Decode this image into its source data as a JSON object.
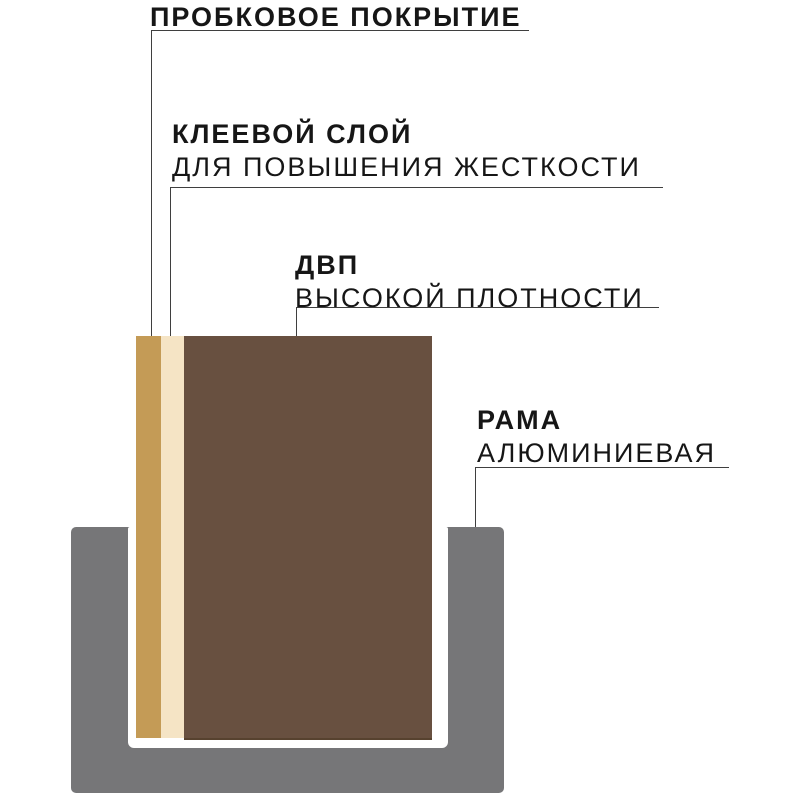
{
  "labels": {
    "cork": {
      "title": "ПРОБКОВОЕ ПОКРЫТИЕ"
    },
    "glue": {
      "title": "КЛЕЕВОЙ СЛОЙ",
      "subtitle": "ДЛЯ ПОВЫШЕНИЯ ЖЕСТКОСТИ"
    },
    "hdf": {
      "title": "ДВП",
      "subtitle": "ВЫСОКОЙ ПЛОТНОСТИ"
    },
    "frame": {
      "title": "РАМА",
      "subtitle": "АЛЮМИНИЕВАЯ"
    }
  },
  "colors": {
    "cork_layer": "#C49B56",
    "glue_layer": "#F5E4C5",
    "hdf_layer": "#685040",
    "frame": "#767678",
    "leader_line": "#3F3F3F",
    "text": "#161616",
    "background": "#FFFFFF"
  }
}
